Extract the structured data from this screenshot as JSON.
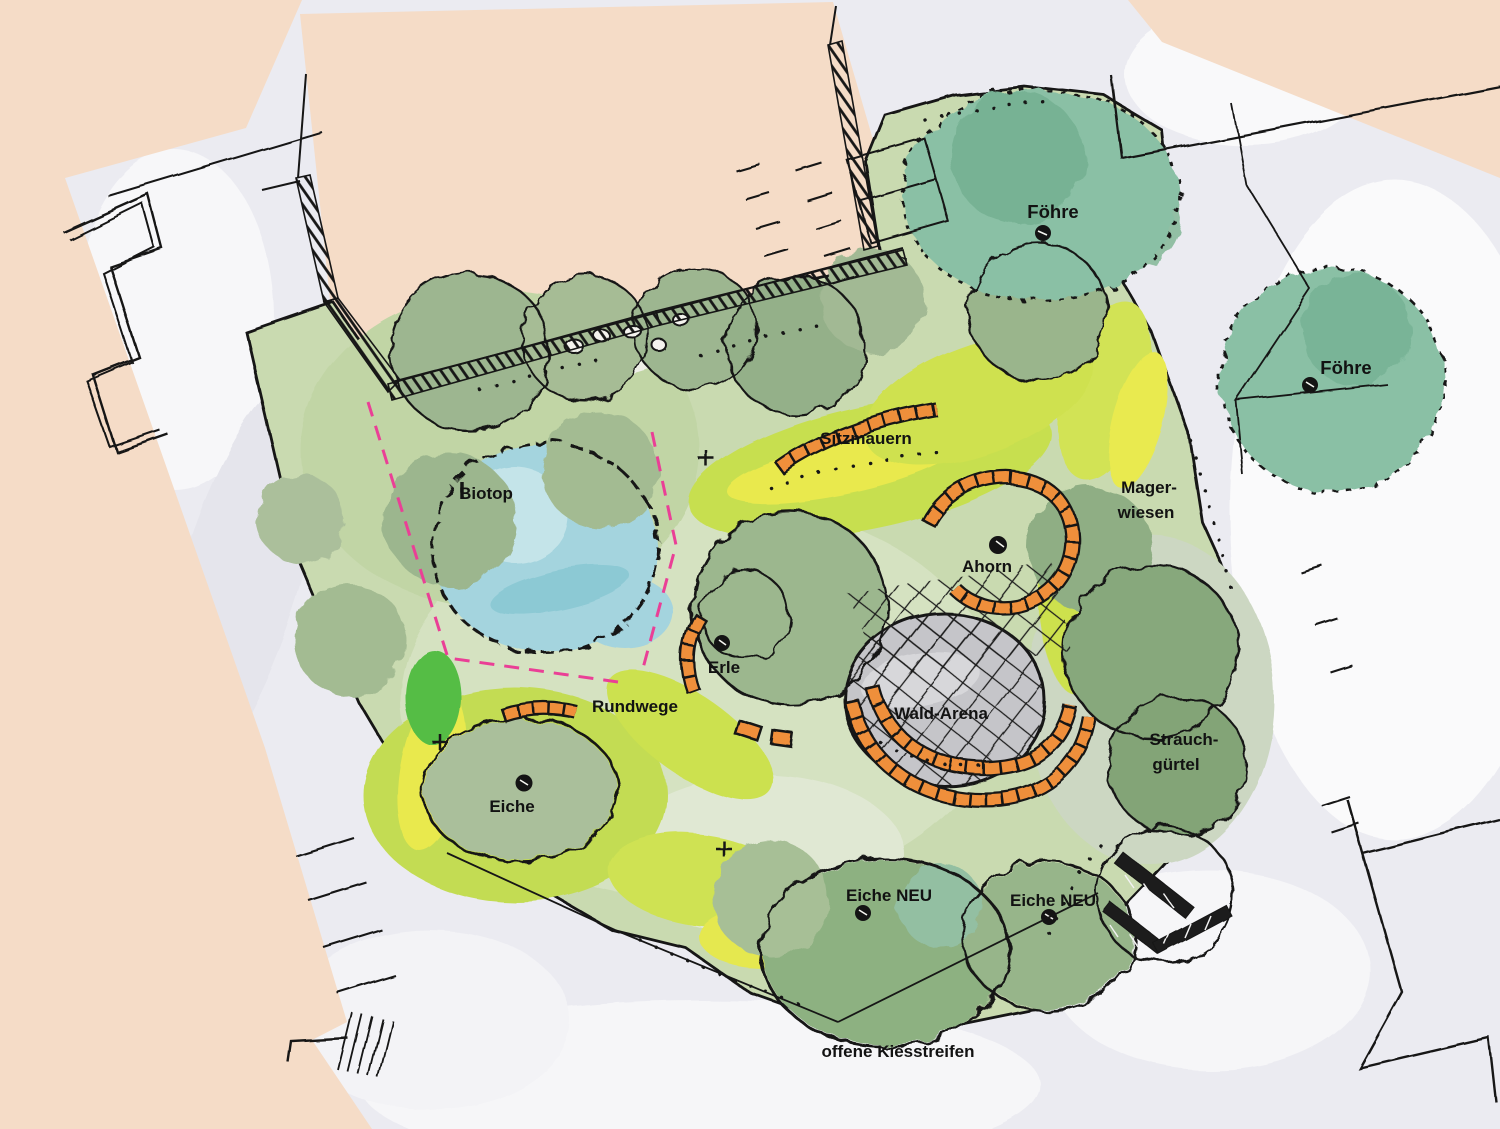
{
  "labels": {
    "foehre_top": "Föhre",
    "foehre_right": "Föhre",
    "sitzmauern": "Sitzmauern",
    "biotop": "Biotop",
    "magerwiesen_line1": "Mager-",
    "magerwiesen_line2": "wiesen",
    "ahorn": "Ahorn",
    "erle": "Erle",
    "rundwege": "Rundwege",
    "wald_arena": "Wald-Arena",
    "strauchguertel_line1": "Strauch-",
    "strauchguertel_line2": "gürtel",
    "eiche": "Eiche",
    "eiche_neu_west": "Eiche NEU",
    "eiche_neu_east": "Eiche NEU",
    "offene_kiesstreifen": "offene Kiesstreifen"
  },
  "colors": {
    "paper": "#f3f3f6",
    "street": "#ebebf1",
    "building_parcel": "#f5dcc7",
    "meadow_base": "#c9dab0",
    "meadow_bright": "#c7df50",
    "meadow_yellow": "#e9e94e",
    "canopy_sage": "#9db690",
    "canopy_teal": "#8ac0a5",
    "biotope_water": "#a4d4de",
    "arena_gravel": "#c5c5c9",
    "seat_wall_orange": "#ef8f3a",
    "boundary_magenta": "#ea3f96",
    "ink": "#161616"
  }
}
